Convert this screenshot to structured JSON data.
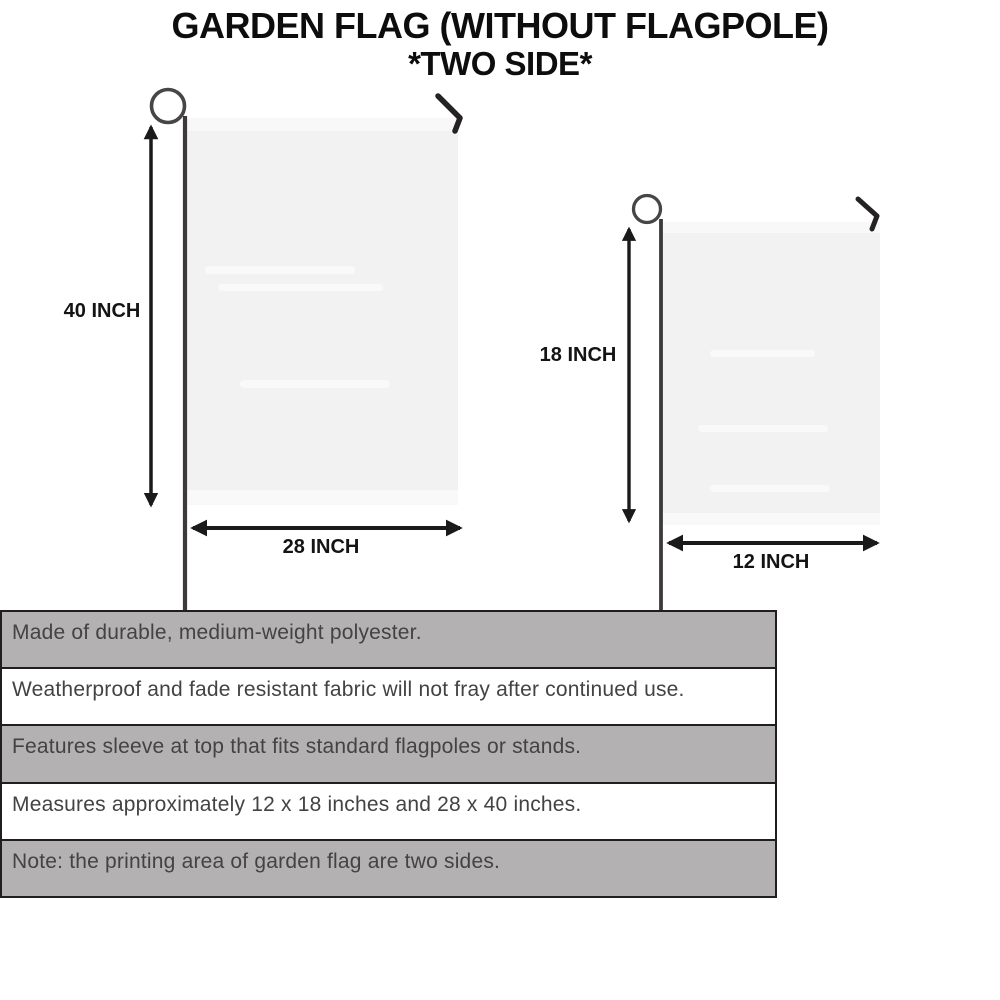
{
  "title": {
    "line1": "GARDEN FLAG (WITHOUT FLAGPOLE)",
    "line2": "*TWO SIDE*"
  },
  "flags": {
    "large": {
      "height_label": "40 INCH",
      "width_label": "28 INCH"
    },
    "small": {
      "height_label": "18 INCH",
      "width_label": "12 INCH"
    }
  },
  "spec_rows": [
    {
      "text": "Made of durable, medium-weight polyester.",
      "shaded": true
    },
    {
      "text": "Weatherproof and fade resistant fabric will not fray after continued use.",
      "shaded": false
    },
    {
      "text": "Features sleeve at top that fits standard flagpoles or stands.",
      "shaded": true
    },
    {
      "text": "Measures approximately 12 x 18 inches and 28 x 40 inches.",
      "shaded": false
    },
    {
      "text": "Note: the printing area of garden flag are two sides.",
      "shaded": true
    }
  ],
  "colors": {
    "row-shaded": "#b3b1b1",
    "row-plain": "#ffffff",
    "table-border": "#1f1f1f",
    "spec-text": "#434343",
    "flag-fill": "#f3f2f2",
    "pole": "#3c3a3a",
    "arrow": "#1a1a1a",
    "title-text": "#0d0d0d",
    "background": "#ffffff"
  }
}
